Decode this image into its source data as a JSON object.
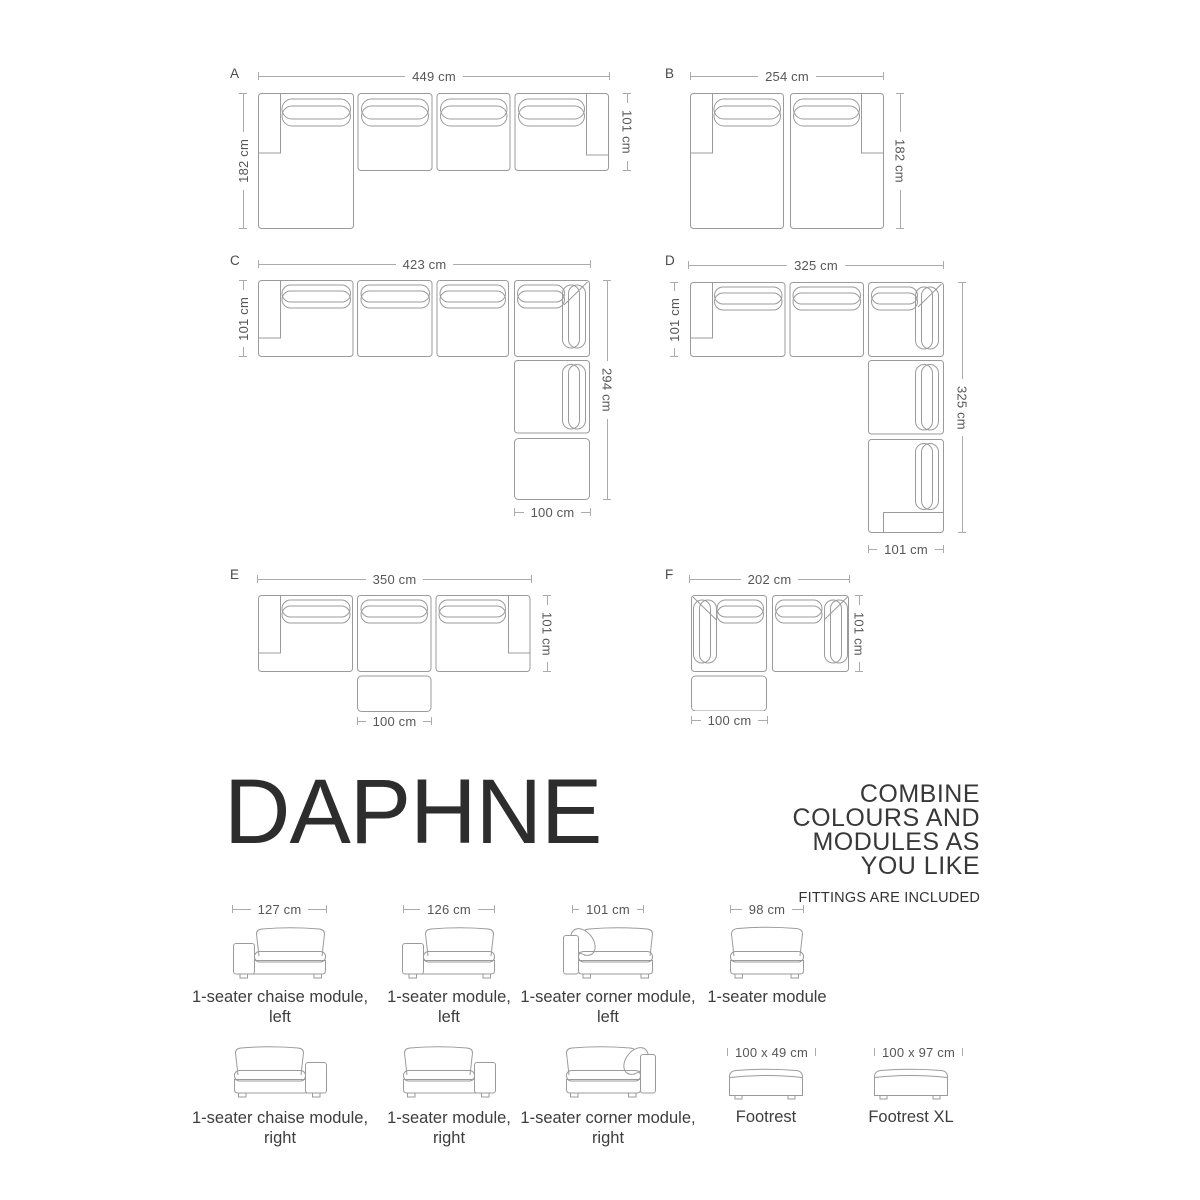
{
  "colors": {
    "furniture_line": "#9b9b9b",
    "dimension_line": "#ababab",
    "dimension_text": "#565656",
    "title_text": "#2d2d2d"
  },
  "configs": {
    "A": {
      "label": "A",
      "width": "449 cm",
      "left": "182 cm",
      "right": "101 cm"
    },
    "B": {
      "label": "B",
      "width": "254 cm",
      "right": "182 cm"
    },
    "C": {
      "label": "C",
      "width": "423 cm",
      "left": "101 cm",
      "right": "294 cm",
      "bottom": "100 cm"
    },
    "D": {
      "label": "D",
      "width": "325 cm",
      "left": "101 cm",
      "right": "325 cm",
      "bottom": "101 cm"
    },
    "E": {
      "label": "E",
      "width": "350 cm",
      "right": "101 cm",
      "bottom": "100 cm"
    },
    "F": {
      "label": "F",
      "width": "202 cm",
      "right": "101 cm",
      "bottom": "100 cm"
    }
  },
  "brand": {
    "title": "DAPHNE",
    "tagline": [
      "COMBINE",
      "COLOURS AND",
      "MODULES AS",
      "YOU LIKE"
    ],
    "note": "FITTINGS ARE INCLUDED"
  },
  "modules": [
    {
      "dim": "127 cm",
      "line1": "1-seater chaise module,",
      "line2": "left"
    },
    {
      "dim": "126 cm",
      "line1": "1-seater module,",
      "line2": "left"
    },
    {
      "dim": "101 cm",
      "line1": "1-seater corner module,",
      "line2": "left"
    },
    {
      "dim": "98 cm",
      "line1": "1-seater module",
      "line2": ""
    },
    {
      "line1": "1-seater chaise module,",
      "line2": "right"
    },
    {
      "line1": "1-seater module,",
      "line2": "right"
    },
    {
      "line1": "1-seater corner module,",
      "line2": "right"
    },
    {
      "dim": "100 x 49 cm",
      "line1": "Footrest",
      "line2": ""
    },
    {
      "dim": "100 x 97 cm",
      "line1": "Footrest XL",
      "line2": ""
    }
  ]
}
